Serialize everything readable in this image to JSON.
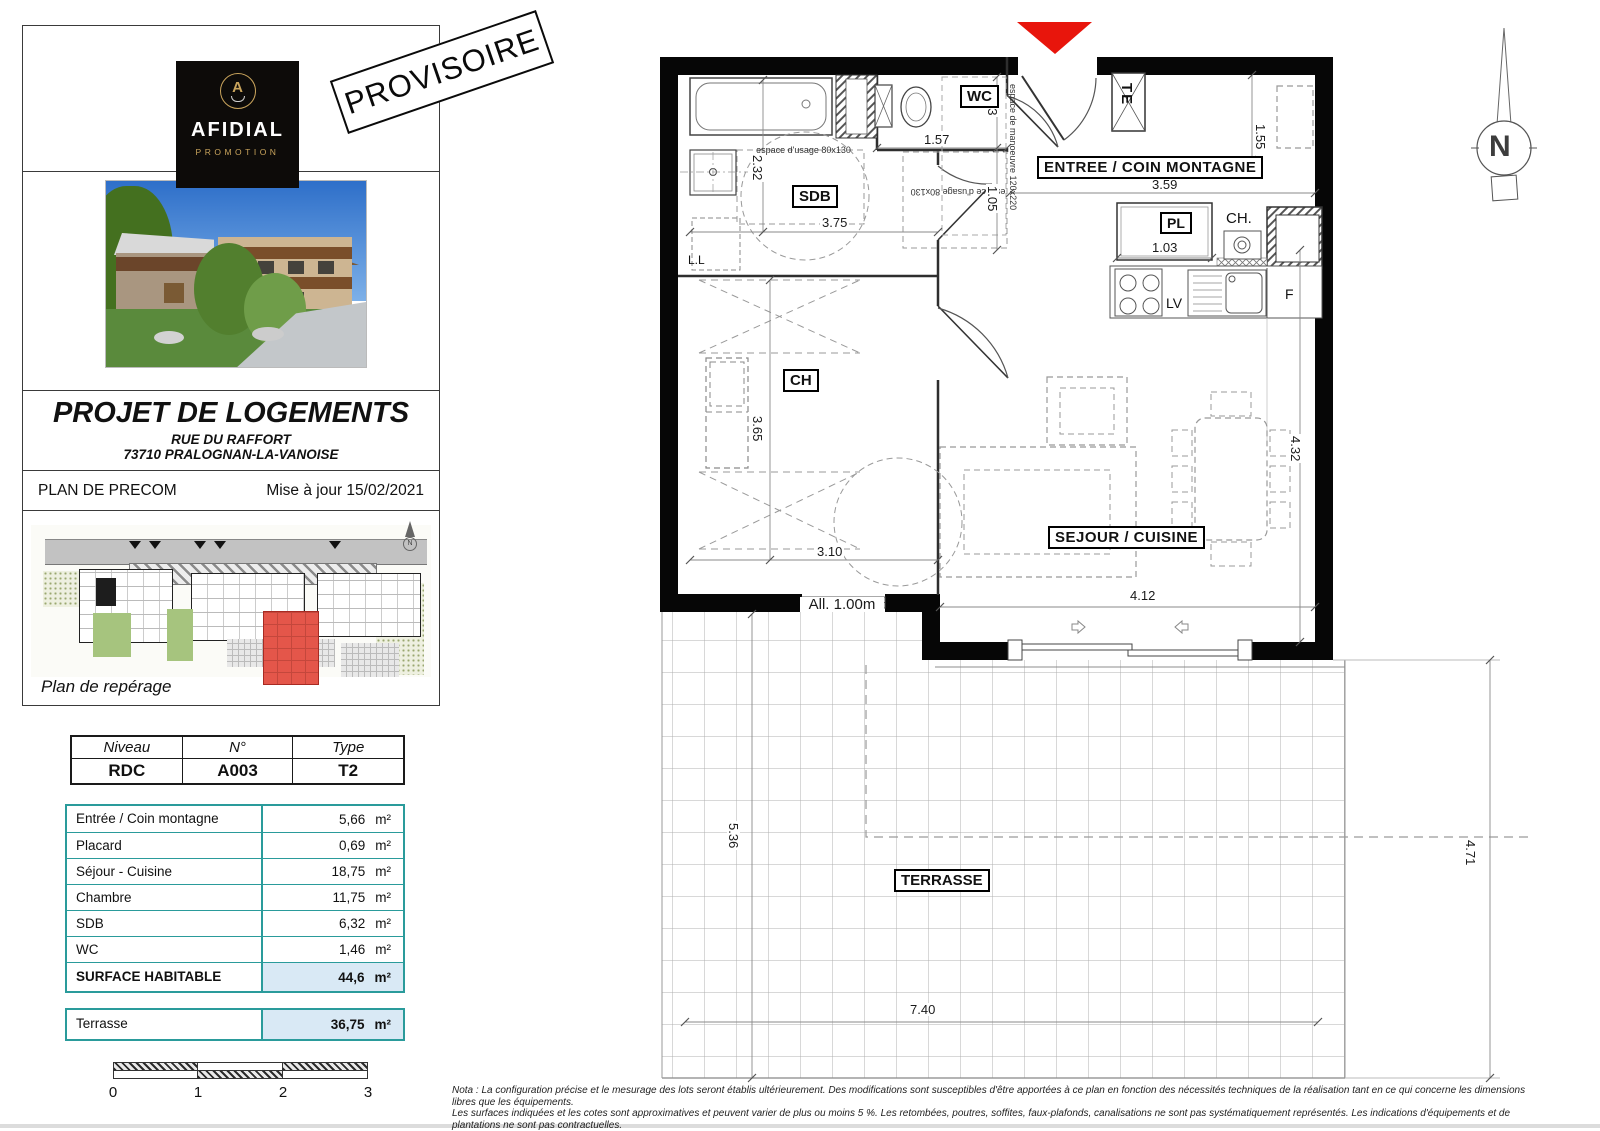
{
  "logo": {
    "brand": "AFIDIAL",
    "sub": "PROMOTION",
    "emblem": "A"
  },
  "stamp": "PROVISOIRE",
  "title_block": {
    "title": "PROJET DE LOGEMENTS",
    "address_line1": "RUE DU RAFFORT",
    "address_line2": "73710 PRALOGNAN-LA-VANOISE",
    "plan_type": "PLAN DE PRECOM",
    "updated": "Mise à jour 15/02/2021",
    "site_caption": "Plan de repérage"
  },
  "unit_table": {
    "headers": [
      "Niveau",
      "N°",
      "Type"
    ],
    "values": [
      "RDC",
      "A003",
      "T2"
    ]
  },
  "areas": {
    "rows": [
      {
        "label": "Entrée / Coin montagne",
        "value": "5,66",
        "unit": "m²"
      },
      {
        "label": "Placard",
        "value": "0,69",
        "unit": "m²"
      },
      {
        "label": "Séjour - Cuisine",
        "value": "18,75",
        "unit": "m²"
      },
      {
        "label": "Chambre",
        "value": "11,75",
        "unit": "m²"
      },
      {
        "label": "SDB",
        "value": "6,32",
        "unit": "m²"
      },
      {
        "label": "WC",
        "value": "1,46",
        "unit": "m²"
      }
    ],
    "total": {
      "label": "SURFACE HABITABLE",
      "value": "44,6",
      "unit": "m²"
    },
    "terrace": {
      "label": "Terrasse",
      "value": "36,75",
      "unit": "m²"
    }
  },
  "scalebar": {
    "ticks": [
      "0",
      "1",
      "2",
      "3"
    ]
  },
  "plan": {
    "rooms": {
      "wc": "WC",
      "sdb": "SDB",
      "entree": "ENTREE / COIN MONTAGNE",
      "pl": "PL",
      "ch_eau": "CH.",
      "chambre": "CH",
      "sejour": "SEJOUR / CUISINE",
      "terrasse": "TERRASSE"
    },
    "equip": {
      "ll": "L.L",
      "te": "TE",
      "lv": "LV",
      "f": "F",
      "allege": "All. 1.00m"
    },
    "annotations": {
      "usage_sdb": "espace d'usage 80x130",
      "usage_wc": "espace d'usage 80x130",
      "manoeuvre": "espace de manoeuvre 120x220"
    },
    "dims": {
      "d232": "2.32",
      "d375": "3.75",
      "d157": "1.57",
      "d093": "93",
      "d105": "1.05",
      "d359": "3.59",
      "d103": "1.03",
      "d155": "1.55",
      "d365": "3.65",
      "d310": "3.10",
      "d432": "4.32",
      "d412": "4.12",
      "d536": "5.36",
      "d471": "4.71",
      "d740": "7.40"
    },
    "north": "N"
  },
  "note": {
    "line1": "Nota : La configuration précise et le mesurage des lots seront établis ultérieurement. Des modifications sont susceptibles d'être apportées à ce plan en fonction des nécessités techniques de la réalisation tant en ce qui concerne les dimensions libres que les équipements.",
    "line2": "Les surfaces indiquées et les cotes sont approximatives et peuvent varier de plus ou moins 5 %. Les retombées, poutres, soffites, faux-plafonds, canalisations ne sont pas systématiquement représentés. Les indications d'équipements et de plantations ne sont pas contractuelles."
  }
}
